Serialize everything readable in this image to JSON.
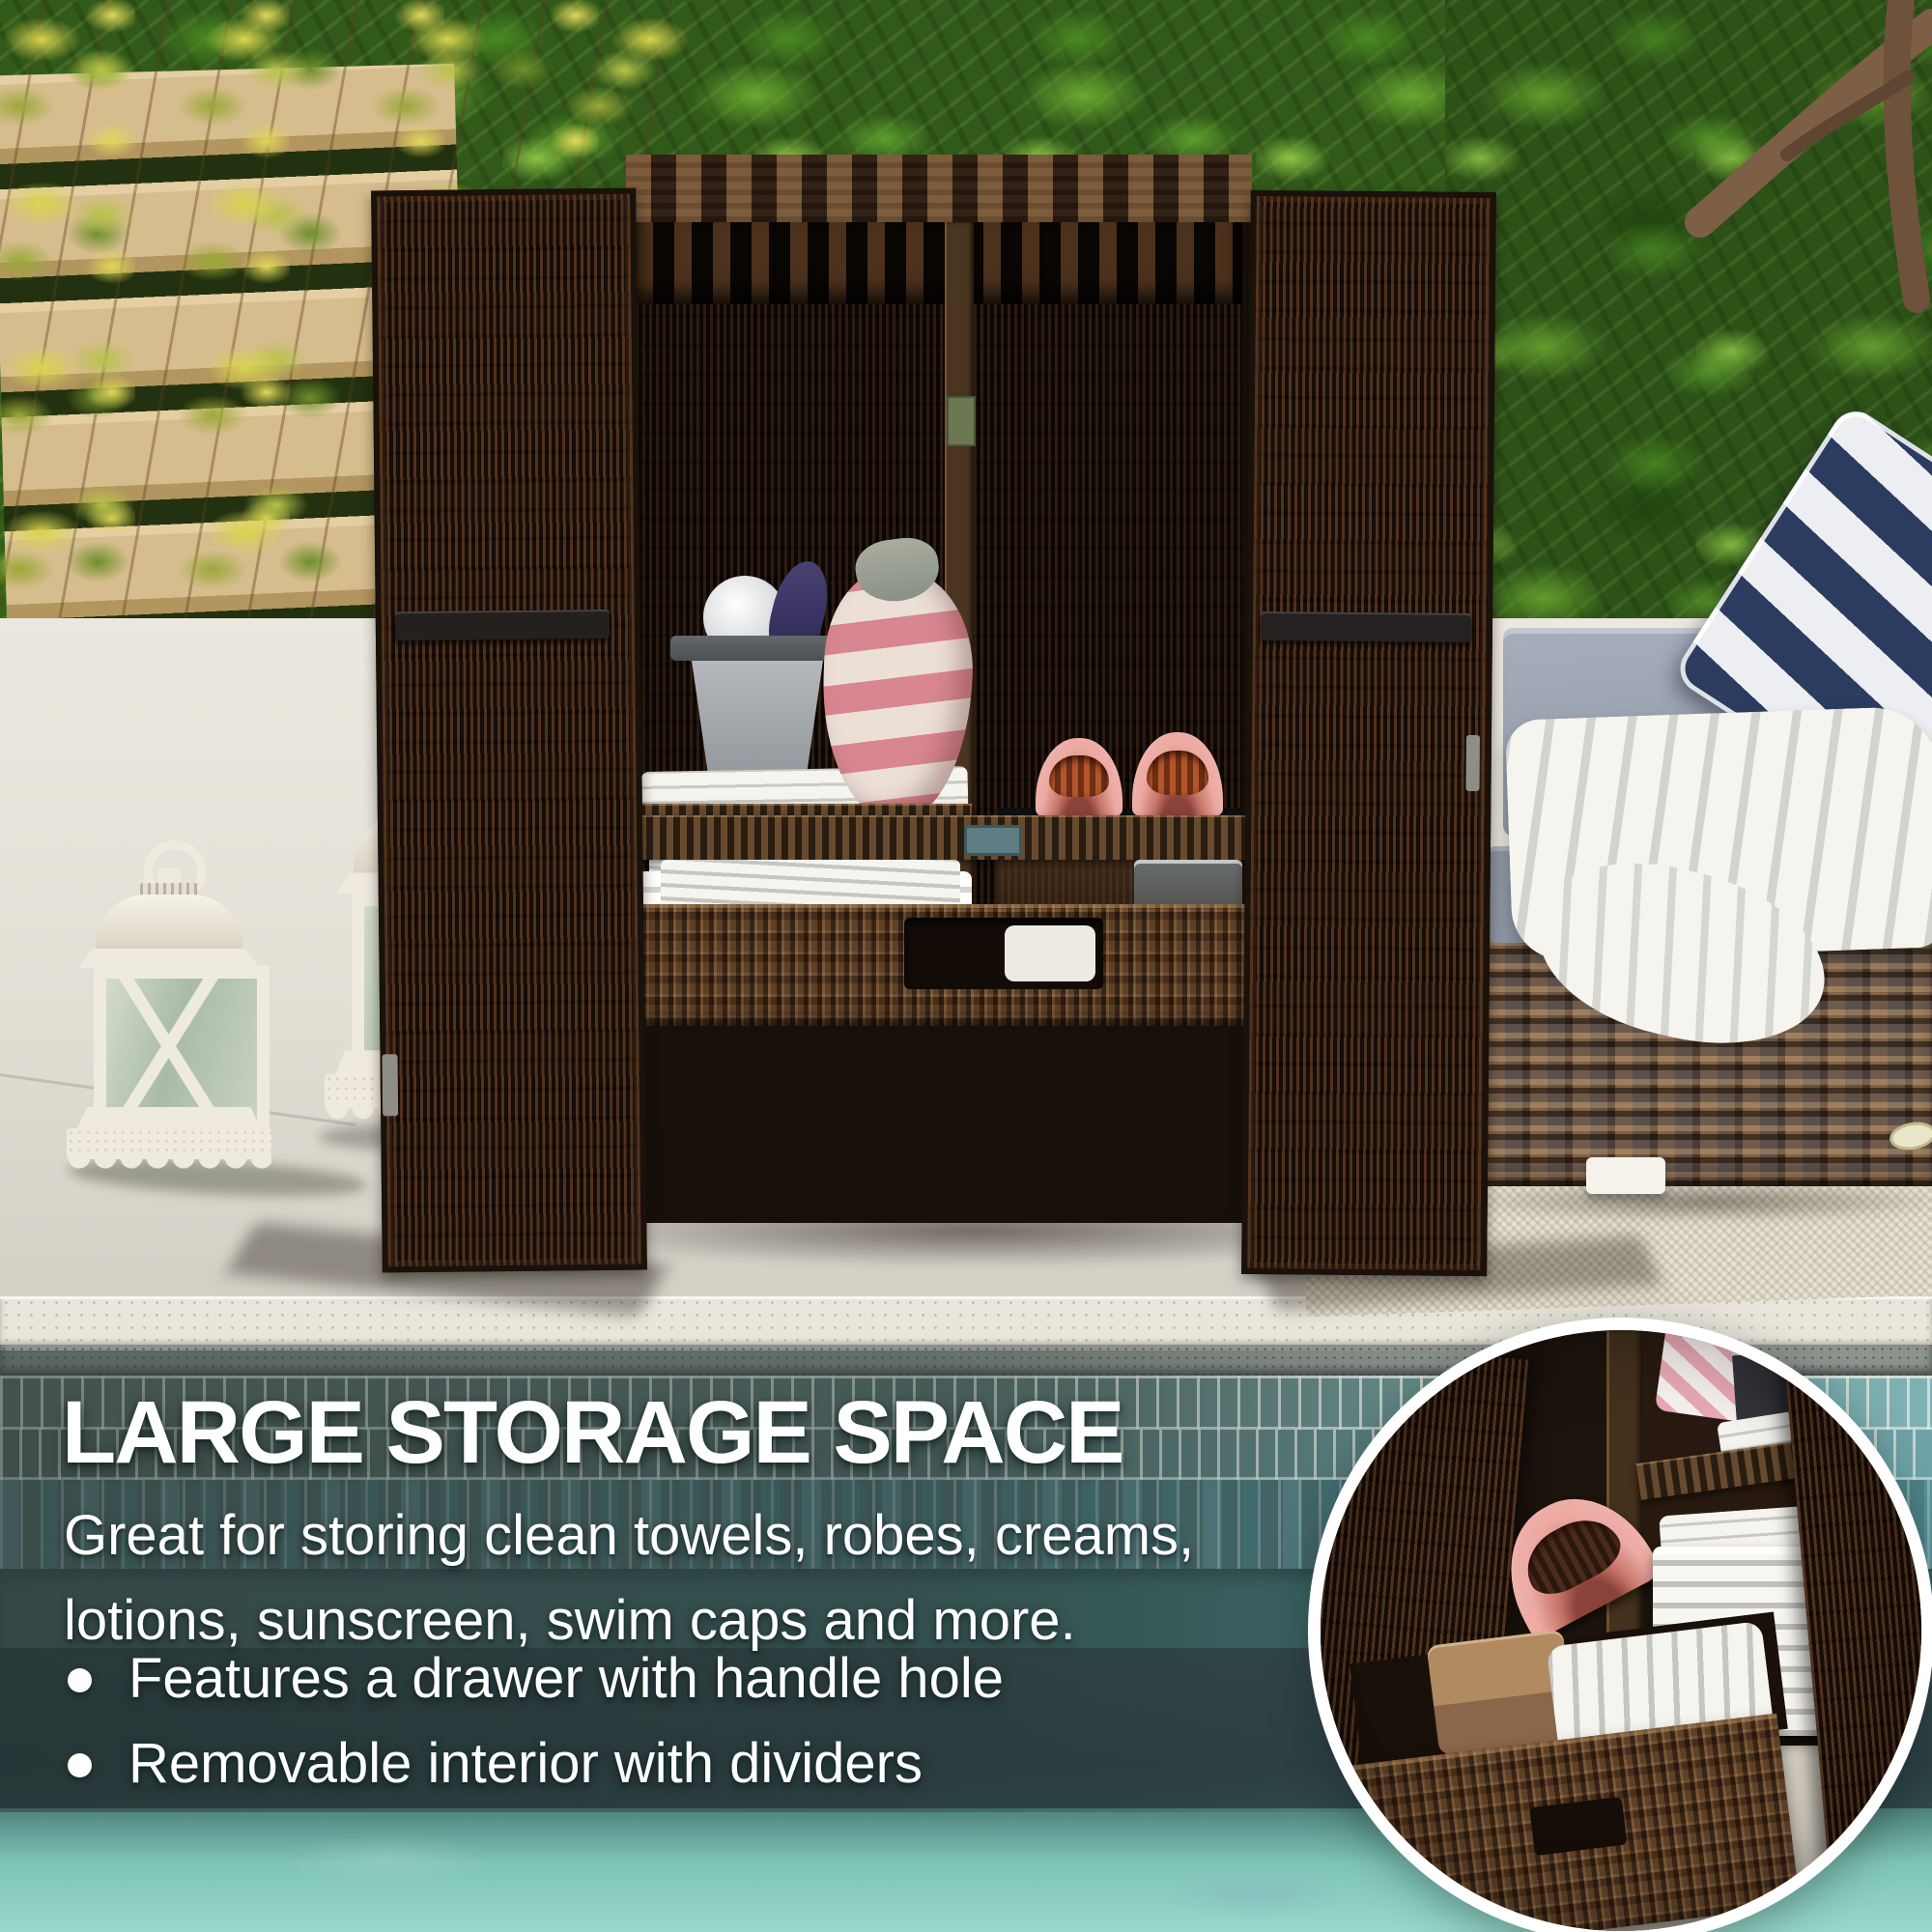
{
  "product_overlay": {
    "heading": "LARGE STORAGE SPACE",
    "description_lines": [
      "Great for storing clean towels, robes, creams,",
      "lotions, sunscreen, swim caps and more."
    ],
    "bullets": [
      "Features a drawer with handle hole",
      "Removable interior with dividers"
    ],
    "bullet_style": "dot"
  },
  "palette": {
    "overlay_text": "#ffffff",
    "wicker_dark": "#261710",
    "wicker_mid": "#543a25",
    "cushion_gray": "#99a1af",
    "pillow_navy": "#2c3c60",
    "slipper_pink": "#eba9a2",
    "lantern_white": "#efeadf",
    "pool_deep_band": "#2f4347",
    "pool_shallow_water": "#8fd2c5",
    "foliage_green": "#4a8a22",
    "vine_yellow": "#d8d44e"
  }
}
